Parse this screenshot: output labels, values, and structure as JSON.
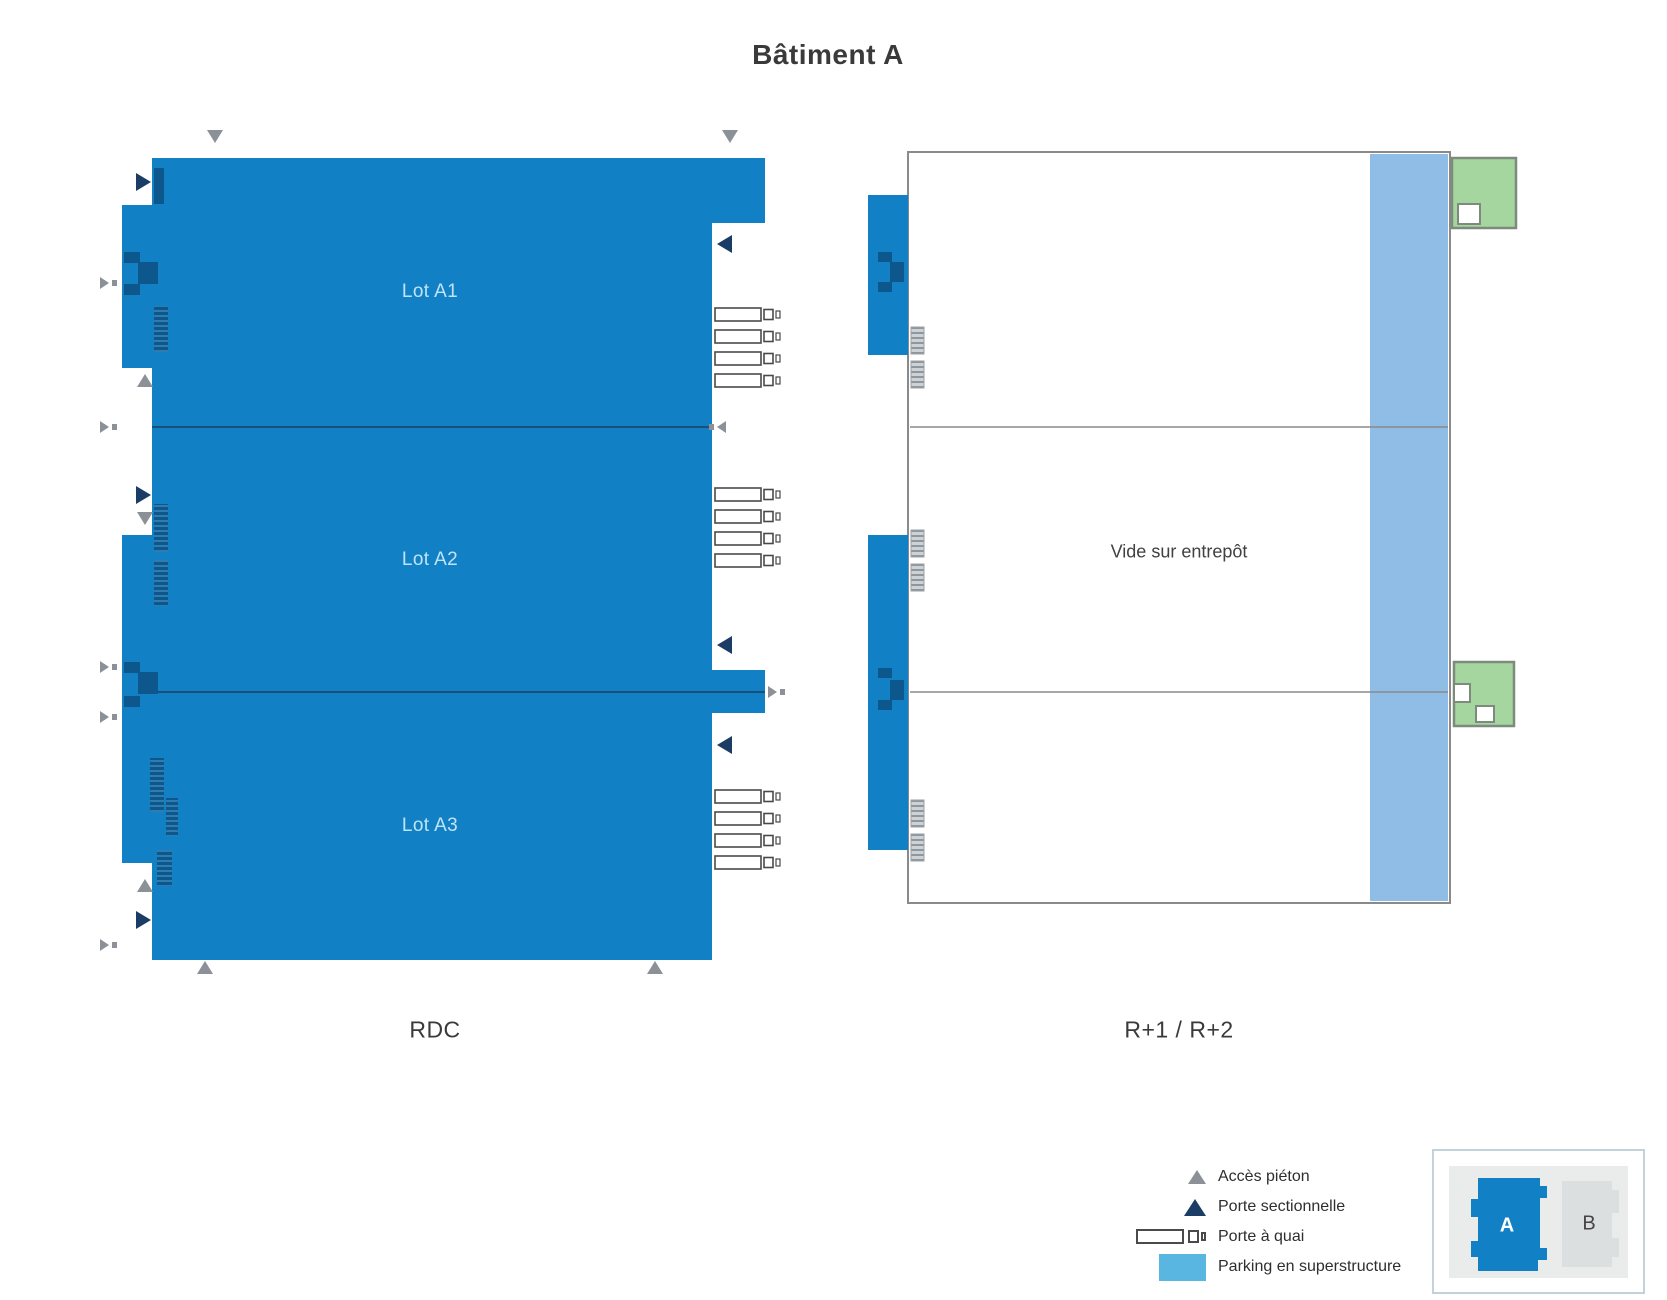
{
  "title": "Bâtiment A",
  "rdc": {
    "label": "RDC",
    "lots": [
      {
        "label": "Lot A1"
      },
      {
        "label": "Lot A2"
      },
      {
        "label": "Lot A3"
      }
    ]
  },
  "upper": {
    "label": "R+1 / R+2",
    "void_label": "Vide sur entrepôt"
  },
  "legend": {
    "items": [
      {
        "icon": "pedestrian-access-icon",
        "label": "Accès piéton"
      },
      {
        "icon": "sectional-door-icon",
        "label": "Porte sectionnelle"
      },
      {
        "icon": "dock-door-icon",
        "label": "Porte à quai"
      },
      {
        "icon": "parking-swatch-icon",
        "label": "Parking en superstructure"
      }
    ]
  },
  "inset": {
    "buildings": [
      {
        "label": "A"
      },
      {
        "label": "B"
      }
    ]
  },
  "colors": {
    "building_blue": "#1280c4",
    "detail_navy": "#0d578c",
    "sectional_navy": "#1b3c64",
    "pedestrian_gray": "#8b9197",
    "parking_strip": "#8fbde5",
    "parking_legend": "#58b6e0",
    "annex_green": "#a6d6a0",
    "annex_green_border": "#7d8b7d",
    "outline_gray": "#8a8a8a"
  }
}
